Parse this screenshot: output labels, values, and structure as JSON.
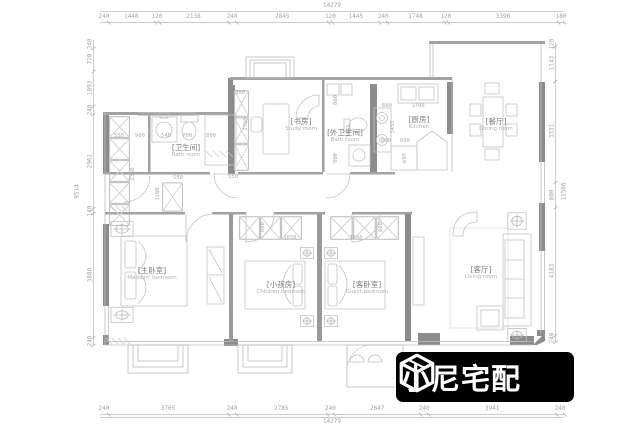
{
  "logo": {
    "text": "小尼宅配",
    "icon": "cube-logo-icon",
    "bg_color": "#000000",
    "fg_color": "#ffffff"
  },
  "colors": {
    "wall": "#8c8c8c",
    "line": "#b5b5b5",
    "dim_text": "#a5a5a5"
  },
  "rooms": [
    {
      "id": "bathroom",
      "cn": "[卫生间]",
      "en": "Bath room"
    },
    {
      "id": "study",
      "cn": "[书房]",
      "en": "Study room"
    },
    {
      "id": "bathroom2",
      "cn": "[外卫生间]",
      "en": "Bath room"
    },
    {
      "id": "kitchen",
      "cn": "[厨房]",
      "en": "Kitchen"
    },
    {
      "id": "dining",
      "cn": "[餐厅]",
      "en": "Dining room"
    },
    {
      "id": "master",
      "cn": "[主卧室]",
      "en": "Masters' bedroom"
    },
    {
      "id": "children",
      "cn": "[小孩房]",
      "en": "Children bedroom"
    },
    {
      "id": "guest",
      "cn": "[客卧室]",
      "en": "Guest bedroom"
    },
    {
      "id": "living",
      "cn": "[客厅]",
      "en": "Living room"
    }
  ],
  "dims": {
    "top": {
      "total": "14279",
      "segments": [
        "240",
        "1448",
        "120",
        "2138",
        "240",
        "2845",
        "120",
        "1445",
        "240",
        "1748",
        "120",
        "3396",
        "180"
      ]
    },
    "bottom": {
      "total": "14279",
      "segments": [
        "240",
        "3705",
        "240",
        "2785",
        "240",
        "2647",
        "240",
        "3941",
        "240"
      ]
    },
    "left": {
      "total": "9514",
      "segments": [
        "240",
        "720",
        "1093",
        "240",
        "2961",
        "140",
        "3880",
        "240"
      ]
    },
    "right": {
      "total": "11566",
      "segments": [
        "120",
        "1143",
        "3331",
        "800",
        "4183",
        "240"
      ]
    }
  },
  "interior_dims": [
    {
      "v": "550",
      "x": 119,
      "y": 136
    },
    {
      "v": "900",
      "x": 140,
      "y": 136
    },
    {
      "v": "540",
      "x": 166,
      "y": 136
    },
    {
      "v": "700",
      "x": 187,
      "y": 136
    },
    {
      "v": "800",
      "x": 211,
      "y": 136
    },
    {
      "v": "2360",
      "x": 133,
      "y": 174,
      "vert": true
    },
    {
      "v": "1180",
      "x": 158,
      "y": 194,
      "vert": true
    },
    {
      "v": "550",
      "x": 178,
      "y": 178
    },
    {
      "v": "300",
      "x": 240,
      "y": 93
    },
    {
      "v": "2760",
      "x": 246,
      "y": 124,
      "vert": true
    },
    {
      "v": "860",
      "x": 336,
      "y": 100,
      "vert": true
    },
    {
      "v": "1355",
      "x": 349,
      "y": 131,
      "vert": true
    },
    {
      "v": "800",
      "x": 336,
      "y": 158,
      "vert": true
    },
    {
      "v": "600",
      "x": 387,
      "y": 106
    },
    {
      "v": "1700",
      "x": 418,
      "y": 106
    },
    {
      "v": "1455",
      "x": 393,
      "y": 127,
      "vert": true
    },
    {
      "v": "600",
      "x": 386,
      "y": 141
    },
    {
      "v": "600",
      "x": 405,
      "y": 141
    },
    {
      "v": "695",
      "x": 405,
      "y": 158,
      "vert": true
    },
    {
      "v": "600",
      "x": 263,
      "y": 227,
      "vert": true
    },
    {
      "v": "1650",
      "x": 290,
      "y": 238
    },
    {
      "v": "1650",
      "x": 356,
      "y": 238
    },
    {
      "v": "600",
      "x": 381,
      "y": 227,
      "vert": true
    },
    {
      "v": "550",
      "x": 233,
      "y": 177
    }
  ]
}
